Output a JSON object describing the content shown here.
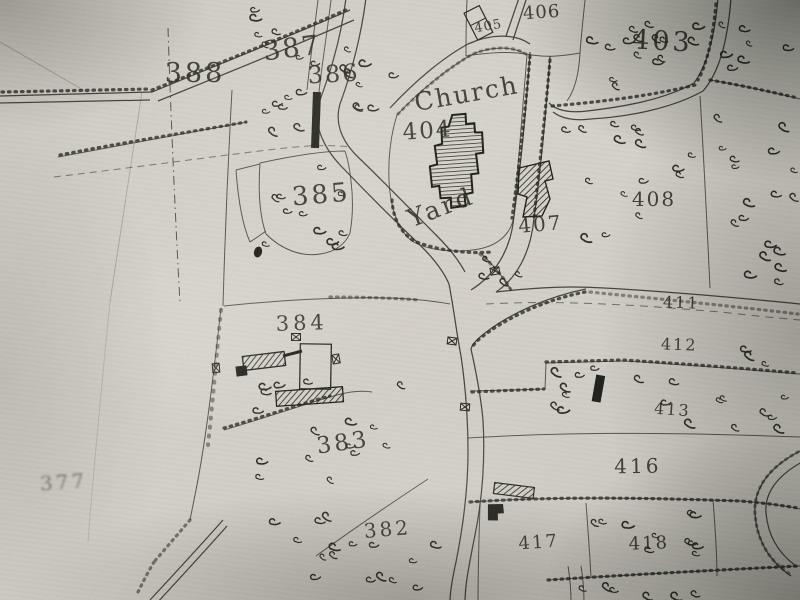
{
  "map": {
    "churchyard_label": {
      "line1": "Church",
      "line2": "Yard"
    },
    "parcel_numbers": {
      "377": "377",
      "382": "382",
      "383": "383",
      "384": "384",
      "385": "385",
      "386": "386",
      "387": "387",
      "388": "388",
      "403": "403",
      "404": "404",
      "405": "405",
      "406": "406",
      "407": "407",
      "408": "408",
      "411": "411",
      "412": "412",
      "413": "413",
      "416": "416",
      "417": "417",
      "418": "418"
    },
    "colors": {
      "ink": "#32322b",
      "paper": "#d2cfc7",
      "vignette": "#3a403a"
    }
  }
}
